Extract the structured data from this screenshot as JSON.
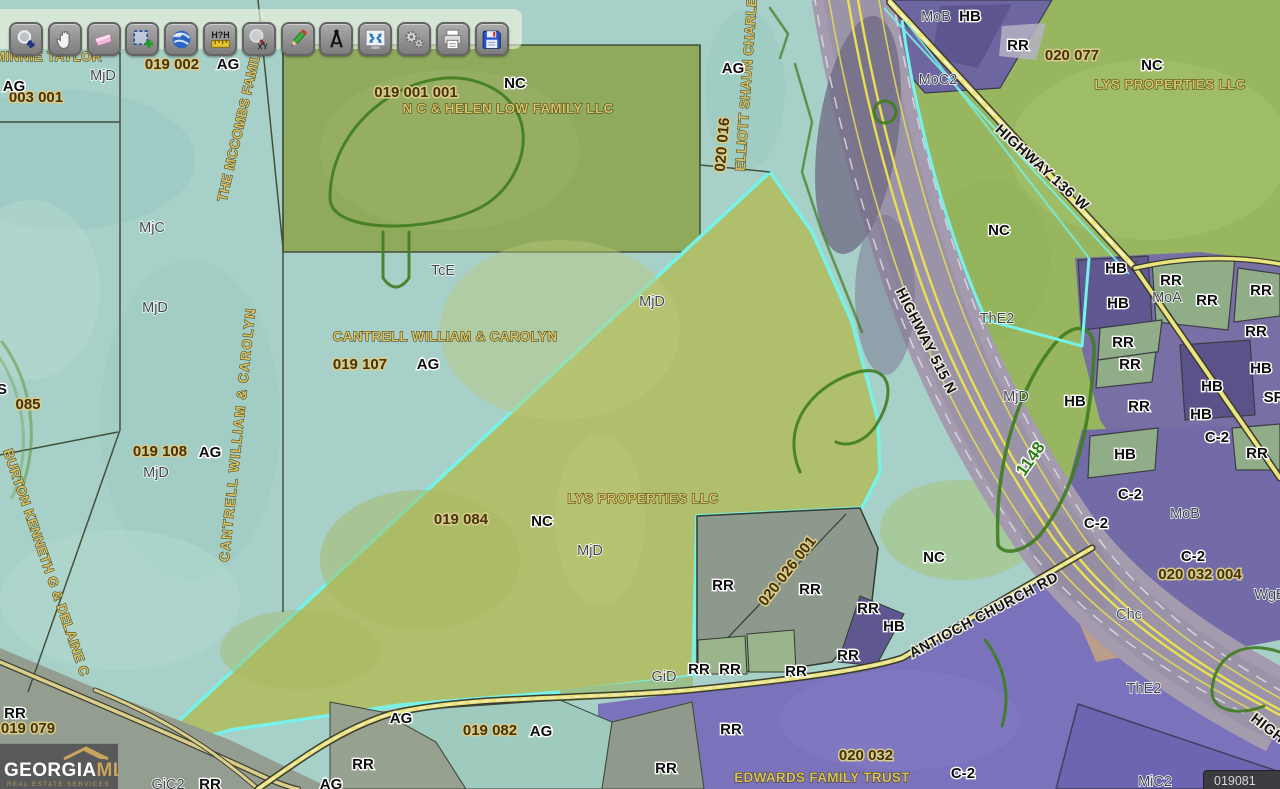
{
  "toolbar": {
    "buttons": [
      {
        "id": "zoom-in",
        "icon": "zoom-in-icon"
      },
      {
        "id": "pan",
        "icon": "pan-hand-icon"
      },
      {
        "id": "eraser",
        "icon": "eraser-icon"
      },
      {
        "id": "select-parcel",
        "icon": "select-plus-icon"
      },
      {
        "id": "earth-view",
        "icon": "globe-icon"
      },
      {
        "id": "measure-distance",
        "icon": "measure-ruler-icon"
      },
      {
        "id": "zoom-to-xy",
        "icon": "zoom-xy-icon"
      },
      {
        "id": "draw",
        "icon": "pencil-icon"
      },
      {
        "id": "bearing",
        "icon": "compass-icon"
      },
      {
        "id": "zoom-extent",
        "icon": "extent-arrows-icon"
      },
      {
        "id": "tools",
        "icon": "gears-icon"
      },
      {
        "id": "print",
        "icon": "printer-icon"
      },
      {
        "id": "save",
        "icon": "save-disk-icon"
      }
    ]
  },
  "logo": {
    "brand_primary": "GEORGIA",
    "brand_secondary": "MLS",
    "tagline": "REAL ESTATE SERVICES"
  },
  "corner_overlay": {
    "text": "019081"
  },
  "palette": {
    "selection_cyan": "#76f2e8",
    "teal_base": "#a7d0c8",
    "selected_parcel_green": "#b0bf6c",
    "zoning_purple": "#7870a5",
    "road_yellow": "#e9e27c",
    "highway_gray": "#a49cae",
    "contour_green": "#3f7d1e"
  },
  "map": {
    "labels": [
      {
        "t": "MINNIE TAYLOR",
        "k": "owner",
        "x": 48,
        "y": 61
      },
      {
        "t": "THE MCCOMBS FAMILY L P",
        "k": "owner",
        "x": 247,
        "y": 112,
        "r": -77
      },
      {
        "t": "N C & HELEN LOW FAMILY LLC",
        "k": "owner",
        "x": 508,
        "y": 113
      },
      {
        "t": "ELLIOTT SHAUN CHARLES",
        "k": "owner",
        "x": 751,
        "y": 80,
        "r": -86
      },
      {
        "t": "CANTRELL WILLIAM & CAROLYN",
        "k": "owner",
        "x": 445,
        "y": 341
      },
      {
        "t": "CANTRELL WILLIAM & CAROLYN",
        "k": "owner",
        "x": 242,
        "y": 435,
        "r": -84,
        "s": 14,
        "ls": 1.5
      },
      {
        "t": "BURTON KENNETH G & DELAINE C",
        "k": "owner",
        "x": 42,
        "y": 564,
        "r": 71,
        "s": 13
      },
      {
        "t": "LYS PROPERTIES LLC",
        "k": "owner",
        "x": 643,
        "y": 503
      },
      {
        "t": "LYS PROPERTIES LLC",
        "k": "owner",
        "x": 1170,
        "y": 89
      },
      {
        "t": "EDWARDS FAMILY TRUST",
        "k": "owner",
        "x": 822,
        "y": 782
      },
      {
        "t": "003 001",
        "k": "pnum",
        "x": 36,
        "y": 102
      },
      {
        "t": "019  002",
        "k": "pnum",
        "x": 172,
        "y": 69
      },
      {
        "t": "019  001 001",
        "k": "pnum",
        "x": 416,
        "y": 97
      },
      {
        "t": "020  016",
        "k": "pnum",
        "x": 727,
        "y": 145,
        "r": -85
      },
      {
        "t": "020  077",
        "k": "pnum",
        "x": 1072,
        "y": 60
      },
      {
        "t": "019  107",
        "k": "pnum",
        "x": 360,
        "y": 369
      },
      {
        "t": "085",
        "k": "pnum",
        "x": 28,
        "y": 409
      },
      {
        "t": "019  108",
        "k": "pnum",
        "x": 160,
        "y": 456
      },
      {
        "t": "019  084",
        "k": "pnum",
        "x": 461,
        "y": 524
      },
      {
        "t": "020  026 001",
        "k": "pnum",
        "x": 791,
        "y": 574,
        "r": -52
      },
      {
        "t": "020  032 004",
        "k": "pnum",
        "x": 1200,
        "y": 579
      },
      {
        "t": "020  032",
        "k": "pnum",
        "x": 866,
        "y": 760
      },
      {
        "t": "019  079",
        "k": "pnum",
        "x": 28,
        "y": 733
      },
      {
        "t": "019  082",
        "k": "pnum",
        "x": 490,
        "y": 735
      },
      {
        "t": "AG",
        "k": "zone",
        "x": 14,
        "y": 91
      },
      {
        "t": "AG",
        "k": "zone",
        "x": 228,
        "y": 69
      },
      {
        "t": "NC",
        "k": "zone",
        "x": 515,
        "y": 88
      },
      {
        "t": "AG",
        "k": "zone",
        "x": 733,
        "y": 73
      },
      {
        "t": "AG",
        "k": "zone",
        "x": 541,
        "y": 736
      },
      {
        "t": "NC",
        "k": "zone",
        "x": 1152,
        "y": 70
      },
      {
        "t": "HB",
        "k": "zone",
        "x": 970,
        "y": 21
      },
      {
        "t": "RR",
        "k": "zone",
        "x": 1018,
        "y": 50
      },
      {
        "t": "NC",
        "k": "zone",
        "x": 999,
        "y": 235
      },
      {
        "t": "HB",
        "k": "zone",
        "x": 1116,
        "y": 273
      },
      {
        "t": "RR",
        "k": "zone",
        "x": 1171,
        "y": 285
      },
      {
        "t": "HB",
        "k": "zone",
        "x": 1118,
        "y": 308
      },
      {
        "t": "RR",
        "k": "zone",
        "x": 1207,
        "y": 305
      },
      {
        "t": "RR",
        "k": "zone",
        "x": 1261,
        "y": 295
      },
      {
        "t": "RR",
        "k": "zone",
        "x": 1123,
        "y": 347
      },
      {
        "t": "RR",
        "k": "zone",
        "x": 1130,
        "y": 369
      },
      {
        "t": "RR",
        "k": "zone",
        "x": 1256,
        "y": 336
      },
      {
        "t": "HB",
        "k": "zone",
        "x": 1261,
        "y": 373
      },
      {
        "t": "HB",
        "k": "zone",
        "x": 1212,
        "y": 391
      },
      {
        "t": "HB",
        "k": "zone",
        "x": 1075,
        "y": 406
      },
      {
        "t": "RR",
        "k": "zone",
        "x": 1139,
        "y": 411
      },
      {
        "t": "HB",
        "k": "zone",
        "x": 1201,
        "y": 419
      },
      {
        "t": "SR",
        "k": "zone",
        "x": 1274,
        "y": 402
      },
      {
        "t": "HB",
        "k": "zone",
        "x": 1125,
        "y": 459
      },
      {
        "t": "RR",
        "k": "zone",
        "x": 1257,
        "y": 458
      },
      {
        "t": "C-2",
        "k": "zone",
        "x": 1217,
        "y": 442
      },
      {
        "t": "C-2",
        "k": "zone",
        "x": 1130,
        "y": 499
      },
      {
        "t": "C-2",
        "k": "zone",
        "x": 1096,
        "y": 528
      },
      {
        "t": "C-2",
        "k": "zone",
        "x": 1193,
        "y": 561
      },
      {
        "t": "NC",
        "k": "zone",
        "x": 934,
        "y": 562
      },
      {
        "t": "HB",
        "k": "zone",
        "x": 894,
        "y": 631
      },
      {
        "t": "RR",
        "k": "zone",
        "x": 723,
        "y": 590
      },
      {
        "t": "RR",
        "k": "zone",
        "x": 810,
        "y": 594
      },
      {
        "t": "RR",
        "k": "zone",
        "x": 868,
        "y": 613
      },
      {
        "t": "RR",
        "k": "zone",
        "x": 848,
        "y": 660
      },
      {
        "t": "RR",
        "k": "zone",
        "x": 699,
        "y": 674
      },
      {
        "t": "RR",
        "k": "zone",
        "x": 730,
        "y": 674
      },
      {
        "t": "RR",
        "k": "zone",
        "x": 796,
        "y": 676
      },
      {
        "t": "RR",
        "k": "zone",
        "x": 731,
        "y": 734
      },
      {
        "t": "RR",
        "k": "zone",
        "x": 666,
        "y": 773
      },
      {
        "t": "RR",
        "k": "zone",
        "x": 363,
        "y": 769
      },
      {
        "t": "AG",
        "k": "zone",
        "x": 401,
        "y": 723
      },
      {
        "t": "AG",
        "k": "zone",
        "x": 331,
        "y": 789
      },
      {
        "t": "RR",
        "k": "zone",
        "x": 210,
        "y": 789
      },
      {
        "t": "RR",
        "k": "zone",
        "x": 15,
        "y": 718
      },
      {
        "t": "C-2",
        "k": "zone",
        "x": 963,
        "y": 778
      },
      {
        "t": "NC",
        "k": "zone",
        "x": 542,
        "y": 526
      },
      {
        "t": "AG",
        "k": "zone",
        "x": 428,
        "y": 369
      },
      {
        "t": "AG",
        "k": "zone",
        "x": 210,
        "y": 457
      },
      {
        "t": "S",
        "k": "zone",
        "x": 2,
        "y": 394
      },
      {
        "t": "MjD",
        "k": "soil",
        "x": 103,
        "y": 80
      },
      {
        "t": "MjC",
        "k": "soil",
        "x": 152,
        "y": 232
      },
      {
        "t": "MjD",
        "k": "soil",
        "x": 155,
        "y": 312
      },
      {
        "t": "TcE",
        "k": "soil",
        "x": 443,
        "y": 275
      },
      {
        "t": "MjD",
        "k": "soil",
        "x": 652,
        "y": 306
      },
      {
        "t": "MjD",
        "k": "soil",
        "x": 156,
        "y": 477
      },
      {
        "t": "MjD",
        "k": "soil",
        "x": 590,
        "y": 555
      },
      {
        "t": "MoB",
        "k": "soil",
        "x": 936,
        "y": 21
      },
      {
        "t": "MoC2",
        "k": "soil",
        "x": 938,
        "y": 84
      },
      {
        "t": "MoA",
        "k": "soil",
        "x": 1167,
        "y": 302
      },
      {
        "t": "ThE2",
        "k": "soil",
        "x": 997,
        "y": 323
      },
      {
        "t": "MjD",
        "k": "soil",
        "x": 1016,
        "y": 401
      },
      {
        "t": "MoB",
        "k": "soil",
        "x": 1185,
        "y": 518
      },
      {
        "t": "Chc",
        "k": "soil",
        "x": 1129,
        "y": 619
      },
      {
        "t": "ThE2",
        "k": "soil",
        "x": 1144,
        "y": 693
      },
      {
        "t": "MiC2",
        "k": "soil",
        "x": 1155,
        "y": 786
      },
      {
        "t": "WgB",
        "k": "soil",
        "x": 1270,
        "y": 599
      },
      {
        "t": "GiD",
        "k": "soil",
        "x": 664,
        "y": 681
      },
      {
        "t": "GiC2",
        "k": "soil",
        "x": 168,
        "y": 789
      },
      {
        "t": "HIGHWAY 136 W",
        "k": "road",
        "x": 1039,
        "y": 171,
        "r": 42
      },
      {
        "t": "HIGHWAY 515 N",
        "k": "road",
        "x": 922,
        "y": 343,
        "r": 63
      },
      {
        "t": "ANTIOCH CHURCH RD",
        "k": "road",
        "x": 986,
        "y": 619,
        "r": -28
      },
      {
        "t": "HIGHWAY 515 N",
        "k": "road",
        "x": 1250,
        "y": 720,
        "r": 38,
        "a": "start"
      },
      {
        "t": "1148",
        "k": "route",
        "x": 1035,
        "y": 462,
        "r": -55
      }
    ]
  }
}
